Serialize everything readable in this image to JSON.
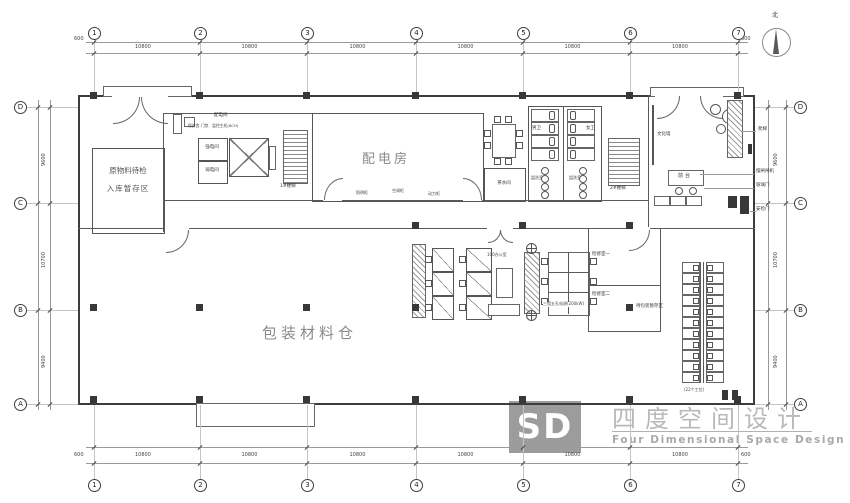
{
  "sheet": {
    "background": "#ffffff",
    "line_color": "#444444",
    "room_label_color": "#8a8a8a",
    "watermark_color": "#b9b9b9"
  },
  "compass": {
    "north_label": "北"
  },
  "grid": {
    "cols": [
      "1",
      "2",
      "3",
      "4",
      "5",
      "6",
      "7"
    ],
    "rows": [
      "D",
      "C",
      "B",
      "A"
    ],
    "top_dims": [
      "10800",
      "10800",
      "10800",
      "10800",
      "10800",
      "10800"
    ],
    "bottom_dims": [
      "10800",
      "10800",
      "10800",
      "10800",
      "10800",
      "10800"
    ],
    "left_dims": [
      "9600",
      "10700",
      "9400"
    ],
    "right_dims": [
      "9600",
      "10700",
      "9400"
    ],
    "end_offset": "600"
  },
  "rooms": {
    "raw_material_line1": "原物料待检",
    "raw_material_line2": "入库暂存区",
    "distribution_room": "配电房",
    "lighting_cabinet": "照明柜",
    "ac_cabinet": "空调柜",
    "power_cabinet": "动力柜",
    "distribution_bay": "配电间",
    "security_note": "保安舍-门禁、监控主机(8CH)",
    "strong_electric": "强电间",
    "weak_electric": "弱电间",
    "stair_1": "1#楼梯",
    "stair_2": "2#楼梯",
    "tea_room": "茶水间",
    "mens_toilet": "男卫",
    "womens_toilet": "女卫",
    "washroom_left": "盥洗室",
    "washroom_right": "盥洗室",
    "culture_wall": "文化墙",
    "reception_desk": "前台",
    "ladder": "爬梯",
    "turnstile": "摆闸闸机",
    "glass_door": "玻璃门",
    "security_door": "安检门",
    "office": "100办公室",
    "reserved_power": "三相五孔电源(200kW)",
    "inspection_room_1": "检修室一",
    "inspection_room_2": "检修室二",
    "packing_buffer": "待包装暂存区",
    "workstation_count": "(22个工位)",
    "packing_warehouse": "包装材料仓"
  },
  "watermark": {
    "logo_text": "SD",
    "title": "四度空间设计",
    "subtitle": "Four Dimensional Space Design"
  },
  "right_block": {
    "rows": 11,
    "cols": 2
  }
}
